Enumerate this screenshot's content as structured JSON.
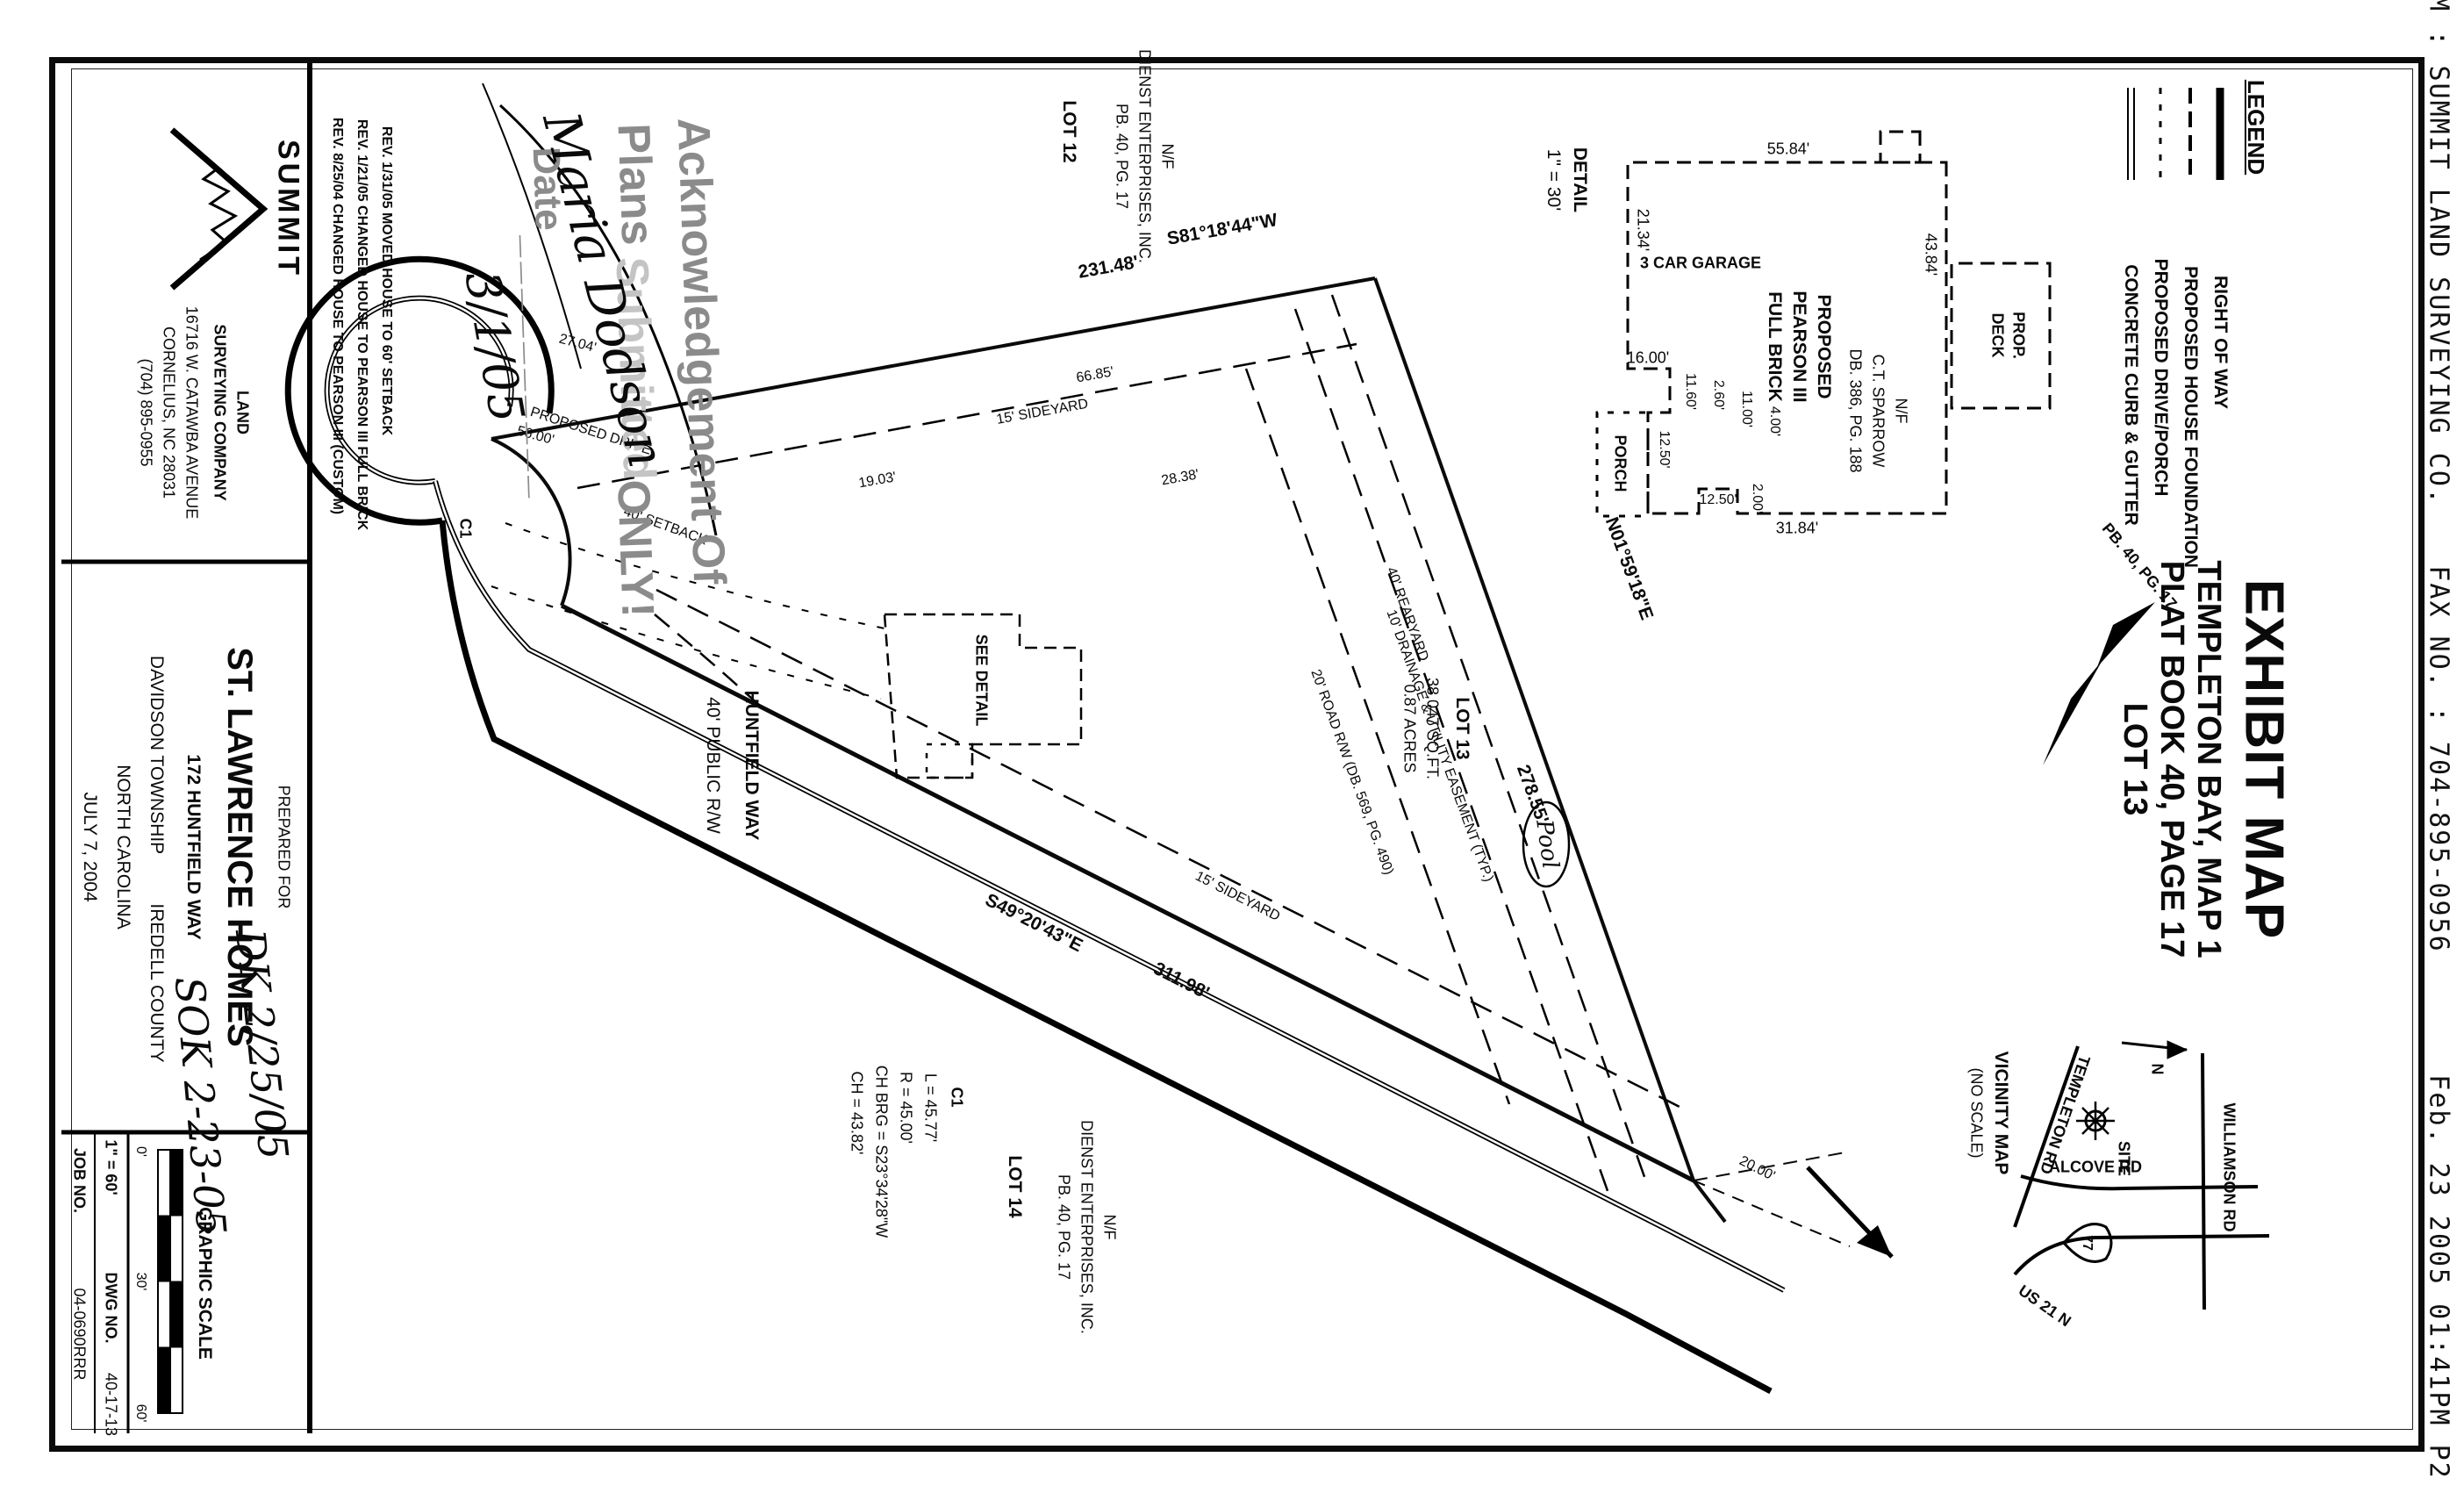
{
  "fax": {
    "from": "FROM : SUMMIT LAND SURVEYING CO.",
    "fax_no": "FAX NO. : 704-895-0956",
    "timestamp": "Feb. 23 2005 01:41PM P2"
  },
  "title_block": {
    "title": "EXHIBIT MAP",
    "line2": "TEMPLETON BAY, MAP 1",
    "line3": "PLAT BOOK 40, PAGE 17",
    "line4": "LOT 13",
    "pointer": "PB. 40, PG. 17"
  },
  "legend": {
    "title": "LEGEND",
    "items": [
      {
        "label": "RIGHT OF WAY"
      },
      {
        "label": "PROPOSED HOUSE FOUNDATION"
      },
      {
        "label": "PROPOSED DRIVE/PORCH"
      },
      {
        "label": "CONCRETE CURB & GUTTER"
      }
    ]
  },
  "vicinity": {
    "title": "VICINITY MAP",
    "subtitle": "(NO SCALE)",
    "north": "N",
    "site": "SITE",
    "shield": "77",
    "templeton": "TEMPLETON RD",
    "williamson": "WILLIAMSON RD",
    "alcove": "ALCOVE RD",
    "us21": "US 21 N"
  },
  "detail": {
    "title": "DETAIL",
    "scale": "1\" = 30'",
    "house1": "PROPOSED",
    "house2": "PEARSON III",
    "house3": "FULL BRICK",
    "garage": "3 CAR GARAGE",
    "deck1": "PROP.",
    "deck2": "DECK",
    "porch": "PORCH",
    "dims": {
      "left": "55.84'",
      "garage_end": "21.34'",
      "garage_jog": "16.00'",
      "d1": "11.60'",
      "d2": "2.60'",
      "d3": "11.00'",
      "d4": "4.00'",
      "porch_w": "12.50'",
      "right": "31.84'",
      "d5": "12.50'",
      "d6": "2.00'",
      "top": "43.84'"
    }
  },
  "plat": {
    "lot13": "LOT 13",
    "area1": "38,047 SQ.FT.",
    "area2": "0.87 ACRES",
    "lot12": "LOT 12",
    "lot12_nf": "N/F",
    "lot12_owner": "DIENST ENTERPRISES, INC.",
    "lot12_ref": "PB. 40, PG. 17",
    "lot14": "LOT 14",
    "lot14_nf": "N/F",
    "lot14_owner": "DIENST ENTERPRISES, INC.",
    "lot14_ref": "PB. 40, PG. 17",
    "sparrow_nf": "N/F",
    "sparrow": "C.T. SPARROW",
    "sparrow_ref": "DB. 386, PG. 188",
    "brg_ab": "S81°18'44\"W",
    "len_ab": "231.48'",
    "brg_bc": "N01°59'18\"E",
    "len_bc": "278.55'",
    "brg_ac": "S49°20'43\"E",
    "len_ac": "311.98'",
    "curve_id": "C1",
    "curve_l": "L = 45.77'",
    "curve_r": "R = 45.00'",
    "curve_chbrg": "CH BRG = S23°34'28\"W",
    "curve_ch": "CH = 43.82'",
    "c1_label": "C1",
    "road1": "HUNTFIELD WAY",
    "road2": "40' PUBLIC R/W",
    "easement": "10' DRAINAGE & UTILITY EASEMENT (TYP.)",
    "road_rw": "20' ROAD R/W (DB. 569, PG. 490)",
    "rearyard": "40' REARYARD",
    "sideyard1": "15' SIDEYARD",
    "sideyard2": "15' SIDEYARD",
    "setback": "40' SETBACK",
    "drive": "PROPOSED DRIVE",
    "see_detail": "SEE DETAIL",
    "pool": "Pool",
    "dim_6685": "66.85'",
    "dim_2704": "27.04'",
    "dim_5600": "56.00'",
    "dim_1903": "19.03'",
    "dim_2838": "28.38'",
    "dim_2000": "20.00'"
  },
  "stamp": {
    "line1": "Acknowledgement Of",
    "word_plans": "Plans",
    "word_submitted": "Submitted",
    "word_only": "ONLY!",
    "date_label": "Date",
    "date_rule": "__________",
    "signature_name": "Maria Dodson",
    "date_value": "3/1/05"
  },
  "titlestrip": {
    "summit": "SUMMIT",
    "co1": "LAND",
    "co2": "SURVEYING COMPANY",
    "co3": "16716 W. CATAWBA AVENUE",
    "co4": "CORNELIUS, NC 28031",
    "co5": "(704) 895-0955",
    "rev1": "REV. 1/31/05 MOVED HOUSE TO 60' SETBACK",
    "rev2": "REV. 1/21/05 CHANGED HOUSE TO PEARSON III FULL BRICK",
    "rev3": "REV. 8/25/04 CHANGED HOUSE TO PEARSON III (CUSTOM)",
    "prepared_for": "PREPARED FOR",
    "client": "ST. LAWRENCE HOMES",
    "address": "172 HUNTFIELD WAY",
    "township": "DAVIDSON TOWNSHIP",
    "county": "IREDELL COUNTY",
    "state": "NORTH CAROLINA",
    "date": "JULY 7, 2004",
    "scale_title": "GRAPHIC SCALE",
    "tick0": "0'",
    "tick30": "30'",
    "tick60": "60'",
    "scale_note": "1\" = 60'",
    "job_label": "JOB NO.",
    "job_value": "04-0690RRR",
    "dwg_label": "DWG NO.",
    "dwg_value": "40-17-13",
    "note1": "DK 2/25/05",
    "note2": "SOK 2-23-05"
  }
}
